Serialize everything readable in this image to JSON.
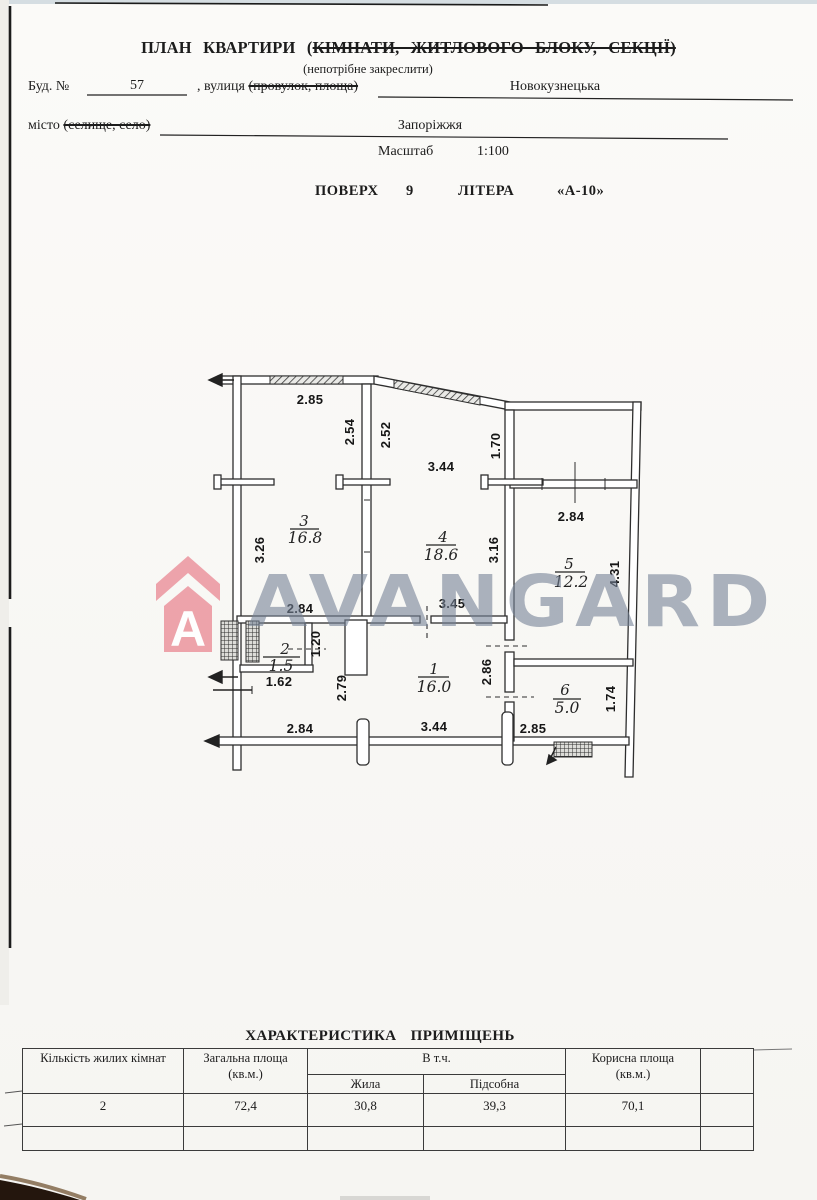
{
  "header": {
    "title_open": "ПЛАН КВАРТИРИ (",
    "title_struck": "КІМНАТИ, ЖИТЛОВОГО БЛОКУ, СЕКЦІЇ)",
    "subtitle": "(непотрібне закреслити)",
    "bud_label": "Буд. №",
    "bud_value": "57",
    "street_label": ", вулиця ",
    "street_struck": "(провулок, площа)",
    "street_value": "Новокузнецька",
    "city_label": "місто ",
    "city_struck": "(селище, село)",
    "city_value": "Запоріжжя",
    "scale_label": "Масштаб",
    "scale_value": "1:100",
    "floor_label": "ПОВЕРХ",
    "floor_value": "9",
    "letter_label": "ЛІТЕРА",
    "letter_value": "«А-10»"
  },
  "watermark": {
    "text": "AVANGARD",
    "logo_letter": "A",
    "logo_color": "#ec9aa3",
    "text_color": "#74829",
    "note_text_color_hex": "#74829b"
  },
  "plan": {
    "dims": [
      "2.85",
      "2.54",
      "2.52",
      "3.44",
      "1.70",
      "3.26",
      "2.84",
      "3.16",
      "4.31",
      "2.84",
      "3.45",
      "1.20",
      "1.62",
      "2.79",
      "2.86",
      "1.74",
      "2.84",
      "3.44",
      "2.85"
    ],
    "rooms": [
      {
        "num": "3",
        "area": "16.8"
      },
      {
        "num": "4",
        "area": "18.6"
      },
      {
        "num": "5",
        "area": "12.2"
      },
      {
        "num": "2",
        "area": "1.5"
      },
      {
        "num": "1",
        "area": "16.0"
      },
      {
        "num": "6",
        "area": "5.0"
      }
    ]
  },
  "table": {
    "title": "ХАРАКТЕРИСТИКА ПРИМІЩЕНЬ",
    "col_rooms": "Кількість жилих кімнат",
    "col_total_1": "Загальна площа",
    "col_total_2": "(кв.м.)",
    "col_incl": "В т.ч.",
    "col_living": "Жила",
    "col_aux": "Підсобна",
    "col_useful_1": "Корисна площа",
    "col_useful_2": "(кв.м.)",
    "row": {
      "rooms": "2",
      "total": "72,4",
      "living": "30,8",
      "aux": "39,3",
      "useful": "70,1"
    }
  }
}
